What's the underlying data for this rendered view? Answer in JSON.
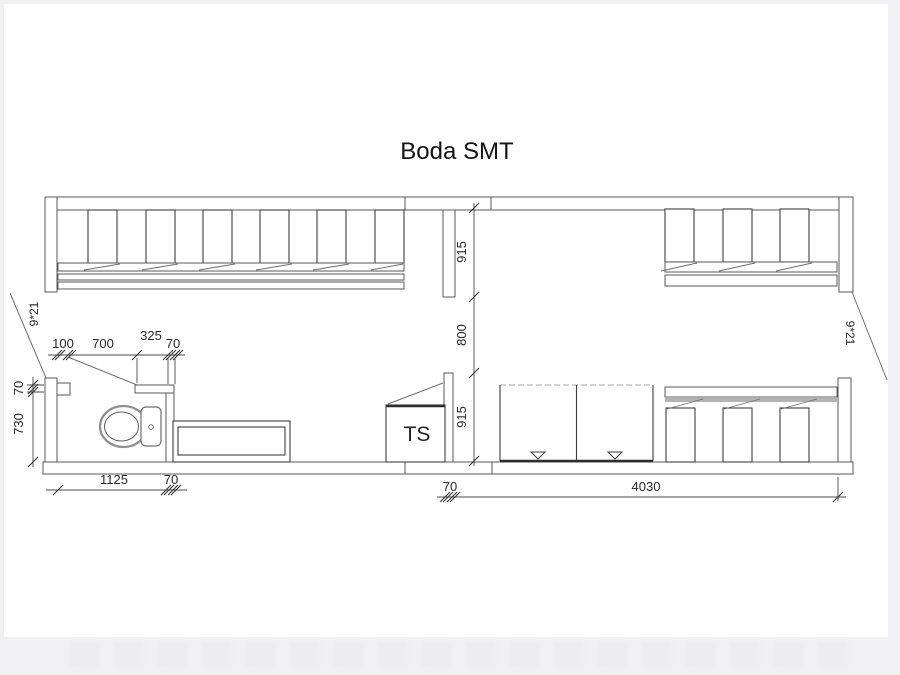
{
  "page": {
    "title_text": "Boda SMT"
  },
  "plan": {
    "unit_labels": {
      "ts": "TS"
    },
    "door_labels": {
      "left": "9*21",
      "right": "9*21"
    },
    "dimensions": {
      "mid_upper": "915",
      "mid_opening": "800",
      "mid_lower": "915",
      "wc_jamb": "100",
      "wc_door_width": "700",
      "wc_to_partition": "325",
      "partition_wall": "70",
      "wc_wall_thickness": "70",
      "wc_inner_depth": "730",
      "wc_inner_width": "1125",
      "wc_right_wall": "70",
      "ts_wall": "70",
      "hall_length": "4030"
    },
    "colors": {
      "background": "#f1f1f3",
      "sheet": "#ffffff",
      "wall_line": "#5a5a5a",
      "furniture_line": "#3f3f3f",
      "shelf_gray": "#b3b3b3",
      "dimension_line": "#4a4a4a"
    }
  }
}
